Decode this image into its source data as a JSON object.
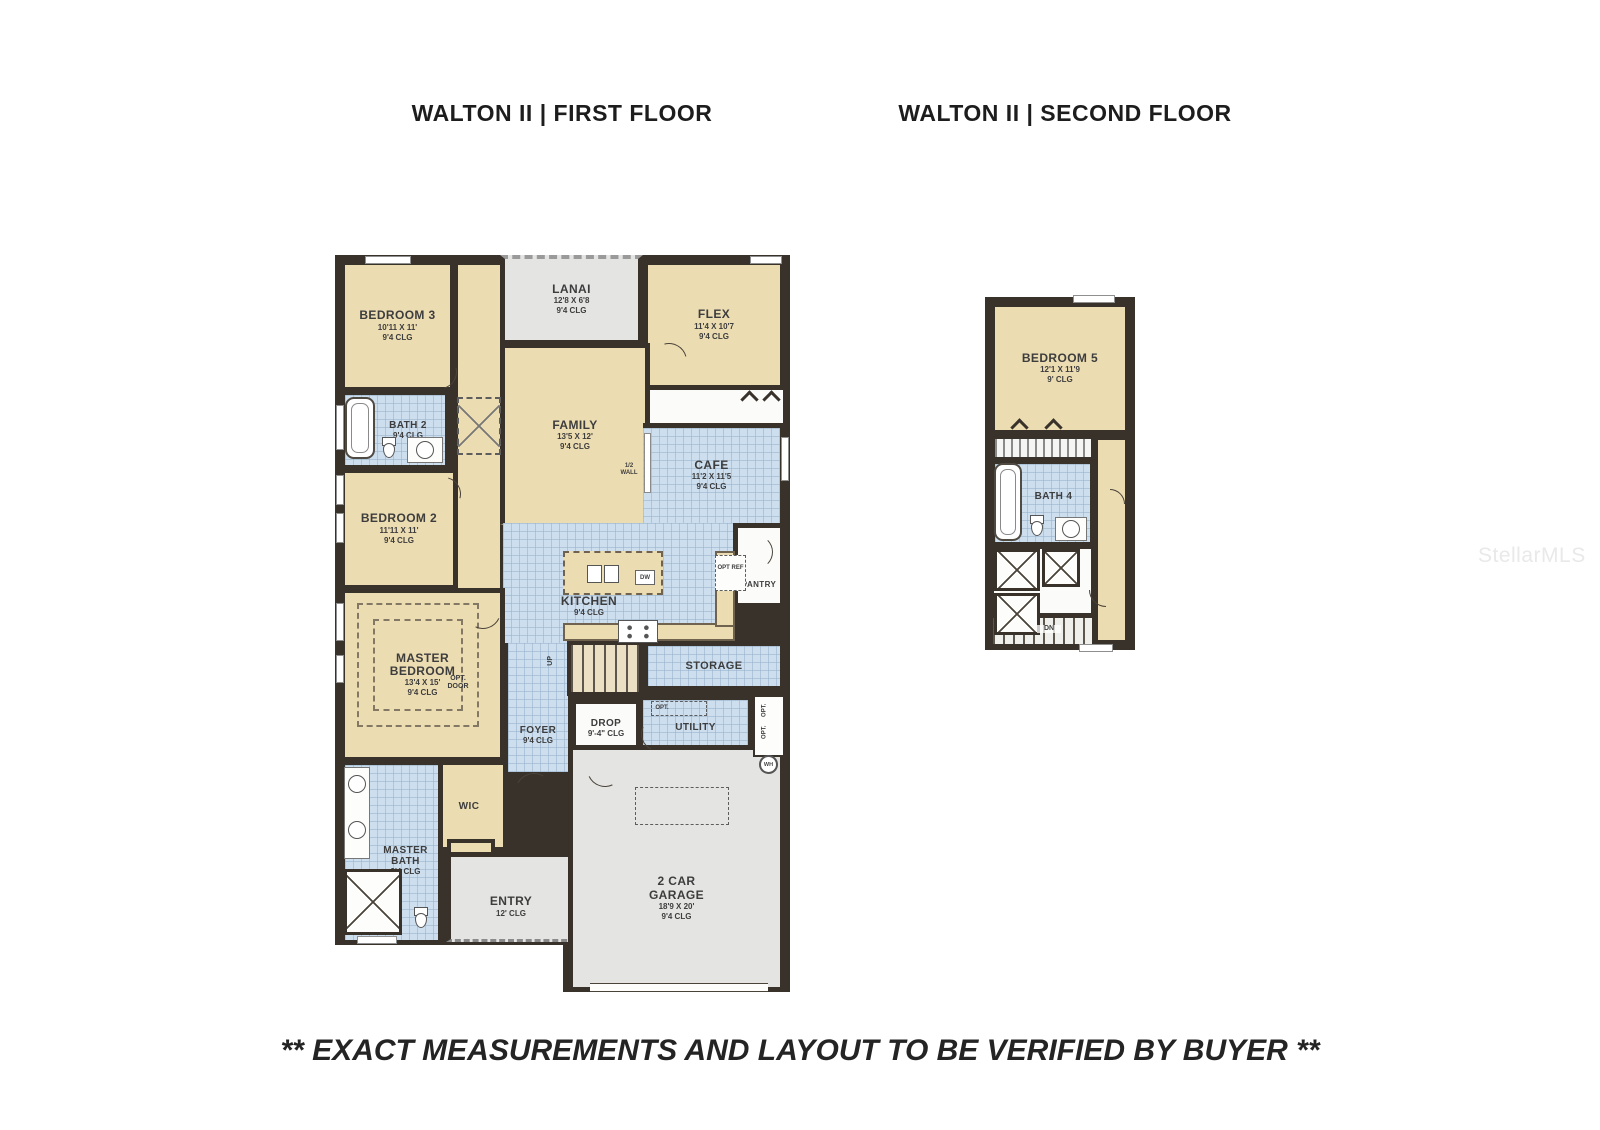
{
  "page": {
    "title_first": "WALTON II | FIRST FLOOR",
    "title_second": "WALTON II | SECOND FLOOR",
    "disclaimer": "** EXACT MEASUREMENTS AND LAYOUT TO BE VERIFIED BY BUYER **",
    "watermark": "StellarMLS"
  },
  "colors": {
    "wall": "#38322b",
    "room_tan": "#ecdcb2",
    "tile_blue": "#cddeee",
    "room_gray": "#e4e4e2",
    "label_text": "#3d3d3d",
    "watermark_gray": "#e9e9e9"
  },
  "first_floor": {
    "bedroom3": {
      "name": "BEDROOM 3",
      "dim": "10'11 X 11'",
      "clg": "9'4 CLG"
    },
    "lanai": {
      "name": "LANAI",
      "dim": "12'8 X 6'8",
      "clg": "9'4 CLG"
    },
    "flex": {
      "name": "FLEX",
      "dim": "11'4 X 10'7",
      "clg": "9'4 CLG"
    },
    "family": {
      "name": "FAMILY",
      "dim": "13'5 X 12'",
      "clg": "9'4 CLG"
    },
    "bath2": {
      "name": "BATH 2",
      "clg": "9'4 CLG"
    },
    "cafe": {
      "name": "CAFE",
      "dim": "11'2 X 11'5",
      "clg": "9'4 CLG"
    },
    "bedroom2": {
      "name": "BEDROOM 2",
      "dim": "11'11 X 11'",
      "clg": "9'4 CLG"
    },
    "kitchen": {
      "name": "KITCHEN",
      "clg": "9'4 CLG"
    },
    "pantry": {
      "name": "PANTRY"
    },
    "master_bedroom": {
      "name": "MASTER BEDROOM",
      "dim": "13'4 X 15'",
      "clg": "9'4 CLG"
    },
    "storage": {
      "name": "STORAGE"
    },
    "foyer": {
      "name": "FOYER",
      "clg": "9'4 CLG"
    },
    "drop": {
      "name": "DROP",
      "clg": "9'-4\" CLG"
    },
    "utility": {
      "name": "UTILITY"
    },
    "wic": {
      "name": "WIC"
    },
    "master_bath": {
      "name": "MASTER BATH",
      "clg": "9'4 CLG"
    },
    "entry": {
      "name": "ENTRY",
      "clg": "12' CLG"
    },
    "garage": {
      "name": "2 CAR GARAGE",
      "dim": "18'9 X 20'",
      "clg": "9'4 CLG"
    }
  },
  "second_floor": {
    "bedroom5": {
      "name": "BEDROOM 5",
      "dim": "12'1 X 11'9",
      "clg": "9' CLG"
    },
    "bath4": {
      "name": "BATH 4"
    }
  },
  "annotations": {
    "up": "UP",
    "dn": "DN",
    "dw": "DW",
    "wh": "WH",
    "opt_ref": "OPT REF",
    "opt_door": "OPT. DOOR",
    "half_wall": "1/2 WALL",
    "opt": "OPT."
  }
}
